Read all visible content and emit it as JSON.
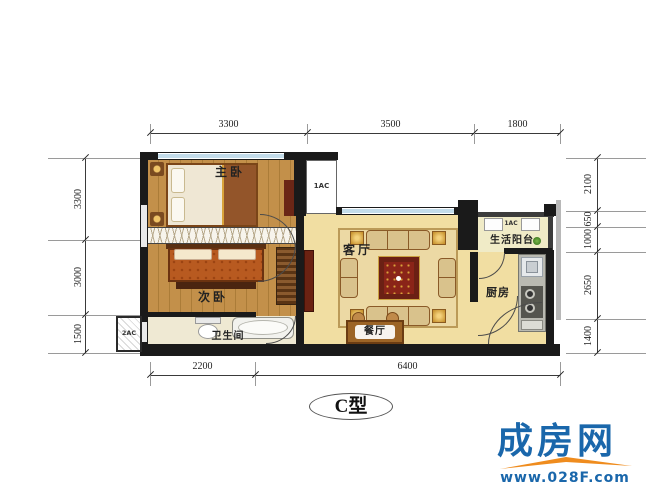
{
  "title": {
    "type_label": "C型"
  },
  "rooms": {
    "master_bedroom": "主卧",
    "second_bedroom": "次卧",
    "bathroom": "卫生间",
    "living_room": "客厅",
    "dining_room": "餐厅",
    "kitchen": "厨房",
    "balcony": "生活阳台"
  },
  "ac_units": {
    "shaft_top": "1AC",
    "balcony": "1AC",
    "side": "2AC"
  },
  "dimensions": {
    "top": [
      "3300",
      "3500",
      "1800"
    ],
    "bottom": [
      "2200",
      "6400"
    ],
    "left": [
      "3300",
      "3000",
      "1500"
    ],
    "right": [
      "2100",
      "650",
      "1000",
      "2650",
      "1400"
    ]
  },
  "watermark": {
    "brand": "成房网",
    "url": "www.028F.com",
    "brand_color": "#1a67ab",
    "roof_color": "#ef8c1e"
  },
  "colors": {
    "wall": "#1a1a1a",
    "window": "#c3dcea",
    "wood_floor": "#c3904a",
    "tile_floor": "#f1dea2",
    "accent_red": "#6b2014"
  }
}
